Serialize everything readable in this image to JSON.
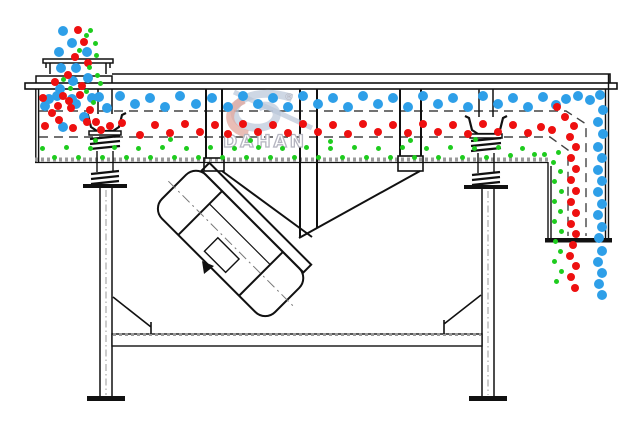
{
  "diagram": {
    "title": "linear-vibrating-screen-particle-flow-diagram",
    "watermark": {
      "brand": "DAHAN",
      "registered": "®"
    },
    "colors": {
      "coarse_particle": "#2e9fe8",
      "medium_particle": "#ee1010",
      "fine_particle": "#1ecc1e",
      "line": "#111111",
      "watermark_blue": "#b9c6d8",
      "watermark_red": "#e2a79e"
    },
    "particles": {
      "groups": [
        {
          "name": "coarse-blue",
          "color": "#2e9fe8",
          "radius": 5,
          "points": [
            [
              63,
              31
            ],
            [
              72,
              43
            ],
            [
              59,
              52
            ],
            [
              87,
              52
            ],
            [
              61,
              68
            ],
            [
              76,
              68
            ],
            [
              88,
              78
            ],
            [
              73,
              81
            ],
            [
              60,
              89
            ],
            [
              49,
              99
            ],
            [
              72,
              99
            ],
            [
              99,
              97
            ],
            [
              45,
              106
            ],
            [
              57,
              96
            ],
            [
              63,
              127
            ],
            [
              76,
              104
            ],
            [
              84,
              117
            ],
            [
              92,
              98
            ],
            [
              107,
              108
            ],
            [
              120,
              96
            ],
            [
              135,
              104
            ],
            [
              150,
              98
            ],
            [
              165,
              107
            ],
            [
              180,
              96
            ],
            [
              196,
              104
            ],
            [
              212,
              98
            ],
            [
              228,
              107
            ],
            [
              243,
              96
            ],
            [
              258,
              104
            ],
            [
              273,
              98
            ],
            [
              288,
              107
            ],
            [
              303,
              96
            ],
            [
              318,
              104
            ],
            [
              333,
              98
            ],
            [
              348,
              107
            ],
            [
              363,
              96
            ],
            [
              378,
              104
            ],
            [
              393,
              98
            ],
            [
              408,
              107
            ],
            [
              423,
              96
            ],
            [
              438,
              104
            ],
            [
              453,
              98
            ],
            [
              468,
              107
            ],
            [
              483,
              96
            ],
            [
              498,
              104
            ],
            [
              513,
              98
            ],
            [
              528,
              107
            ],
            [
              543,
              97
            ],
            [
              556,
              105
            ],
            [
              566,
              99
            ],
            [
              578,
              96
            ],
            [
              590,
              100
            ],
            [
              600,
              95
            ],
            [
              603,
              110
            ],
            [
              598,
              122
            ],
            [
              603,
              134
            ],
            [
              598,
              147
            ],
            [
              602,
              158
            ],
            [
              598,
              170
            ],
            [
              602,
              181
            ],
            [
              598,
              192
            ],
            [
              602,
              204
            ],
            [
              598,
              215
            ],
            [
              602,
              227
            ],
            [
              599,
              238
            ],
            [
              602,
              251
            ],
            [
              598,
              262
            ],
            [
              602,
              273
            ],
            [
              599,
              284
            ],
            [
              602,
              295
            ]
          ]
        },
        {
          "name": "medium-red",
          "color": "#ee1010",
          "radius": 4,
          "points": [
            [
              78,
              30
            ],
            [
              84,
              42
            ],
            [
              75,
              57
            ],
            [
              88,
              63
            ],
            [
              68,
              75
            ],
            [
              55,
              82
            ],
            [
              82,
              86
            ],
            [
              63,
              96
            ],
            [
              80,
              95
            ],
            [
              71,
              108
            ],
            [
              58,
              106
            ],
            [
              90,
              110
            ],
            [
              43,
              98
            ],
            [
              52,
              113
            ],
            [
              69,
              101
            ],
            [
              96,
              122
            ],
            [
              110,
              126
            ],
            [
              45,
              126
            ],
            [
              59,
              120
            ],
            [
              73,
              128
            ],
            [
              87,
              122
            ],
            [
              101,
              130
            ],
            [
              122,
              123
            ],
            [
              140,
              135
            ],
            [
              155,
              125
            ],
            [
              170,
              133
            ],
            [
              185,
              124
            ],
            [
              200,
              132
            ],
            [
              215,
              125
            ],
            [
              228,
              134
            ],
            [
              243,
              124
            ],
            [
              258,
              132
            ],
            [
              273,
              125
            ],
            [
              288,
              133
            ],
            [
              303,
              124
            ],
            [
              318,
              132
            ],
            [
              333,
              125
            ],
            [
              348,
              134
            ],
            [
              363,
              124
            ],
            [
              378,
              132
            ],
            [
              393,
              125
            ],
            [
              408,
              133
            ],
            [
              423,
              124
            ],
            [
              438,
              132
            ],
            [
              453,
              125
            ],
            [
              468,
              134
            ],
            [
              483,
              124
            ],
            [
              498,
              132
            ],
            [
              513,
              125
            ],
            [
              528,
              133
            ],
            [
              541,
              127
            ],
            [
              552,
              130
            ],
            [
              557,
              107
            ],
            [
              565,
              117
            ],
            [
              574,
              126
            ],
            [
              570,
              137
            ],
            [
              576,
              147
            ],
            [
              571,
              158
            ],
            [
              576,
              169
            ],
            [
              571,
              180
            ],
            [
              576,
              191
            ],
            [
              571,
              202
            ],
            [
              576,
              213
            ],
            [
              571,
              224
            ],
            [
              576,
              234
            ],
            [
              573,
              245
            ],
            [
              570,
              256
            ],
            [
              576,
              266
            ],
            [
              571,
              277
            ],
            [
              575,
              288
            ]
          ]
        },
        {
          "name": "fine-green",
          "color": "#1ecc1e",
          "radius": 2.5,
          "points": [
            [
              90,
              30
            ],
            [
              95,
              43
            ],
            [
              86,
              35
            ],
            [
              96,
              55
            ],
            [
              89,
              67
            ],
            [
              97,
              75
            ],
            [
              86,
              91
            ],
            [
              93,
              102
            ],
            [
              63,
              79
            ],
            [
              70,
              88
            ],
            [
              100,
              83
            ],
            [
              79,
              50
            ],
            [
              95,
              140
            ],
            [
              170,
              139
            ],
            [
              250,
              140
            ],
            [
              330,
              141
            ],
            [
              410,
              140
            ],
            [
              475,
              139
            ],
            [
              42,
              148
            ],
            [
              54,
              157
            ],
            [
              66,
              147
            ],
            [
              78,
              157
            ],
            [
              90,
              148
            ],
            [
              102,
              157
            ],
            [
              114,
              147
            ],
            [
              126,
              157
            ],
            [
              138,
              148
            ],
            [
              150,
              157
            ],
            [
              162,
              147
            ],
            [
              174,
              157
            ],
            [
              186,
              148
            ],
            [
              198,
              157
            ],
            [
              210,
              147
            ],
            [
              222,
              157
            ],
            [
              234,
              148
            ],
            [
              246,
              157
            ],
            [
              258,
              147
            ],
            [
              270,
              157
            ],
            [
              282,
              148
            ],
            [
              294,
              157
            ],
            [
              306,
              147
            ],
            [
              318,
              157
            ],
            [
              330,
              148
            ],
            [
              342,
              157
            ],
            [
              354,
              147
            ],
            [
              366,
              157
            ],
            [
              378,
              148
            ],
            [
              390,
              157
            ],
            [
              402,
              147
            ],
            [
              414,
              157
            ],
            [
              426,
              148
            ],
            [
              438,
              157
            ],
            [
              450,
              147
            ],
            [
              462,
              157
            ],
            [
              474,
              148
            ],
            [
              486,
              157
            ],
            [
              498,
              147
            ],
            [
              510,
              155
            ],
            [
              522,
              148
            ],
            [
              534,
              154
            ],
            [
              544,
              154
            ],
            [
              558,
              152
            ],
            [
              553,
              162
            ],
            [
              560,
              171
            ],
            [
              554,
              181
            ],
            [
              561,
              191
            ],
            [
              554,
              201
            ],
            [
              560,
              211
            ],
            [
              554,
              221
            ],
            [
              561,
              231
            ],
            [
              555,
              241
            ],
            [
              560,
              251
            ],
            [
              554,
              261
            ],
            [
              561,
              271
            ],
            [
              556,
              281
            ]
          ]
        }
      ]
    }
  }
}
